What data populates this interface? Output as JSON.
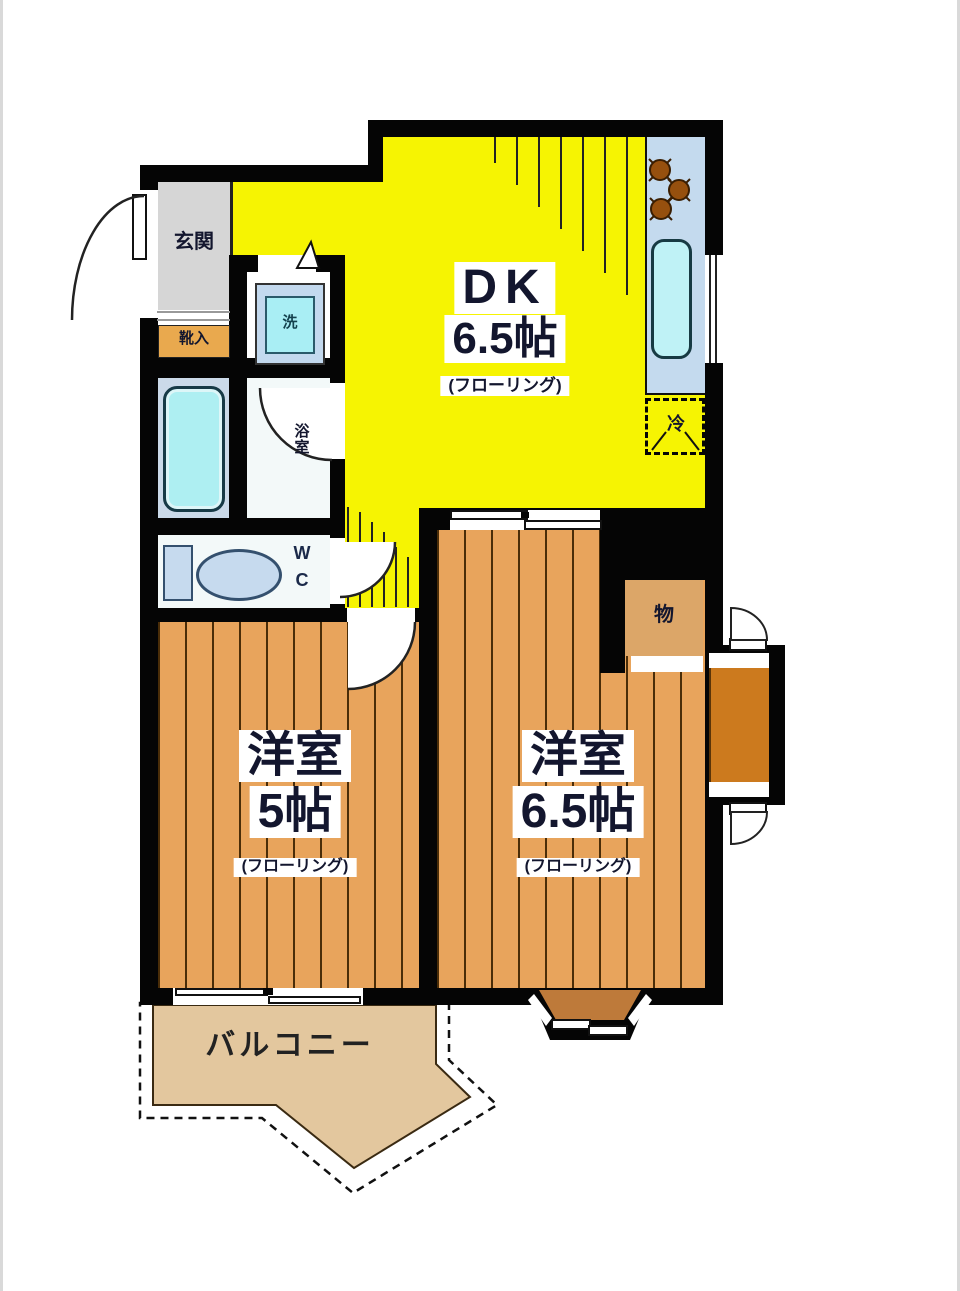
{
  "plan": {
    "dk": {
      "name": "DK",
      "size": "6.5帖",
      "floor": "(フローリング)"
    },
    "western_5": {
      "name": "洋室",
      "size": "5帖",
      "floor": "(フローリング)"
    },
    "western_65": {
      "name": "洋室",
      "size": "6.5帖",
      "floor": "(フローリング)"
    },
    "balcony": {
      "name": "バルコニー"
    },
    "entrance": {
      "name": "玄関"
    },
    "shoe_cabinet": {
      "name": "靴入"
    },
    "washer": {
      "name": "洗"
    },
    "bathroom": {
      "name_vertical": [
        "浴",
        "室"
      ]
    },
    "wc": {
      "lines": [
        "W",
        "C"
      ]
    },
    "refrigerator": {
      "name": "冷"
    },
    "storage": {
      "name": "物"
    }
  },
  "colors": {
    "dk_yellow": "#f6f402",
    "wood_floor": "#e8a45c",
    "plank_line": "#4a2d08",
    "wall_black": "#050505",
    "balcony_floor": "#e3c79e",
    "bay_window_brown": "#be7a3a",
    "outer_closet_orange": "#cc7a1e",
    "storage_tan": "#dca668",
    "shoe_cabinet_orange": "#e9a94e",
    "entrance_gray": "#d6d6d6",
    "kitchen_counter_blue": "#c4daee",
    "fixture_cyan": "#aeeff2",
    "sink_cyan": "#bff2f6",
    "toilet_blue": "#c6daee",
    "bath_floor_blue": "#cbdae9",
    "room_floor_white": "#f3f9f9"
  }
}
